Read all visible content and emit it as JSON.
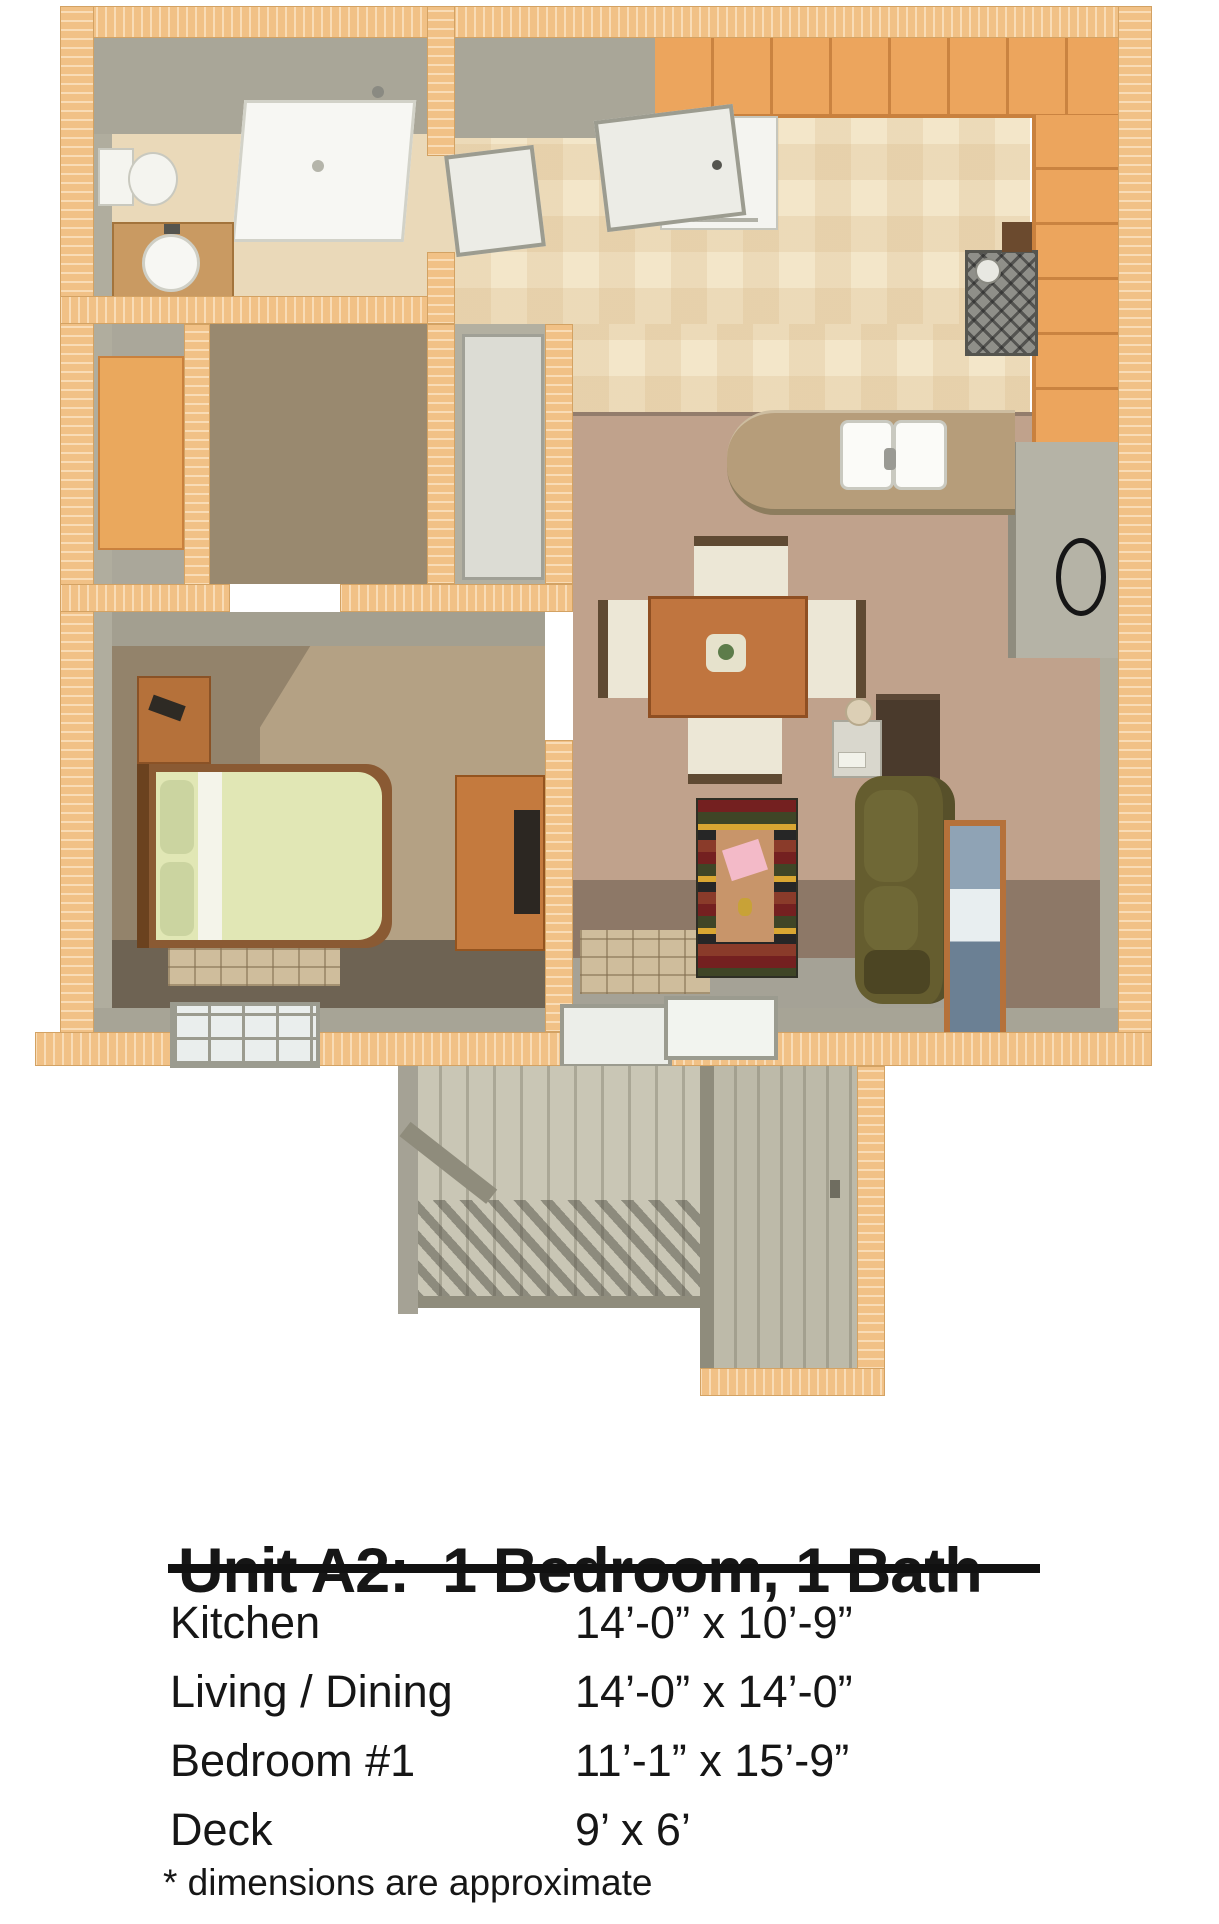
{
  "floorplan": {
    "description": "3D top-down rendered floor plan of apartment unit A2 with attached deck",
    "rooms": [
      "bathroom",
      "closet",
      "hall",
      "linen-closet",
      "kitchen",
      "dining-area",
      "living-room",
      "entry",
      "bedroom",
      "deck",
      "storage-closet"
    ],
    "furniture": [
      "shower",
      "vanity-sink",
      "toilet",
      "refrigerator",
      "range-stove",
      "double-sink",
      "peninsula-counter",
      "dining-table",
      "dining-chairs",
      "area-rug",
      "sofa",
      "tv-cabinet",
      "desk-phone",
      "framed-picture",
      "wall-mirror",
      "bed",
      "nightstand",
      "dresser-tv",
      "sliding-glass-door",
      "window"
    ],
    "palette": {
      "exterior_wall_wood": "#f1c186",
      "interior_wall_gray": "#a9a698",
      "tile_floor": "#f3e6c9",
      "carpet_living": "#c0a28c",
      "carpet_living_shade": "#8d7867",
      "carpet_bedroom": "#93836b",
      "cabinet_orange": "#eca55d",
      "counter_tan": "#b69d7a",
      "sofa_olive": "#655d2f",
      "bed_mattress_green": "#e1e7b5",
      "table_wood": "#c0753f",
      "deck_gray": "#c9c6b5",
      "rug_red": "#742020",
      "rug_green": "#3f4526",
      "rug_yellow": "#d9a632",
      "text_black": "#111111"
    }
  },
  "details": {
    "title": "Unit A2:  1 Bedroom, 1 Bath",
    "rows": [
      {
        "room": "Kitchen",
        "size": "14’-0” x 10’-9”"
      },
      {
        "room": "Living / Dining",
        "size": "14’-0” x 14’-0”"
      },
      {
        "room": "Bedroom #1",
        "size": "11’-1” x 15’-9”"
      },
      {
        "room": "Deck",
        "size": "9’ x 6’"
      }
    ],
    "footnote": "* dimensions are approximate"
  }
}
